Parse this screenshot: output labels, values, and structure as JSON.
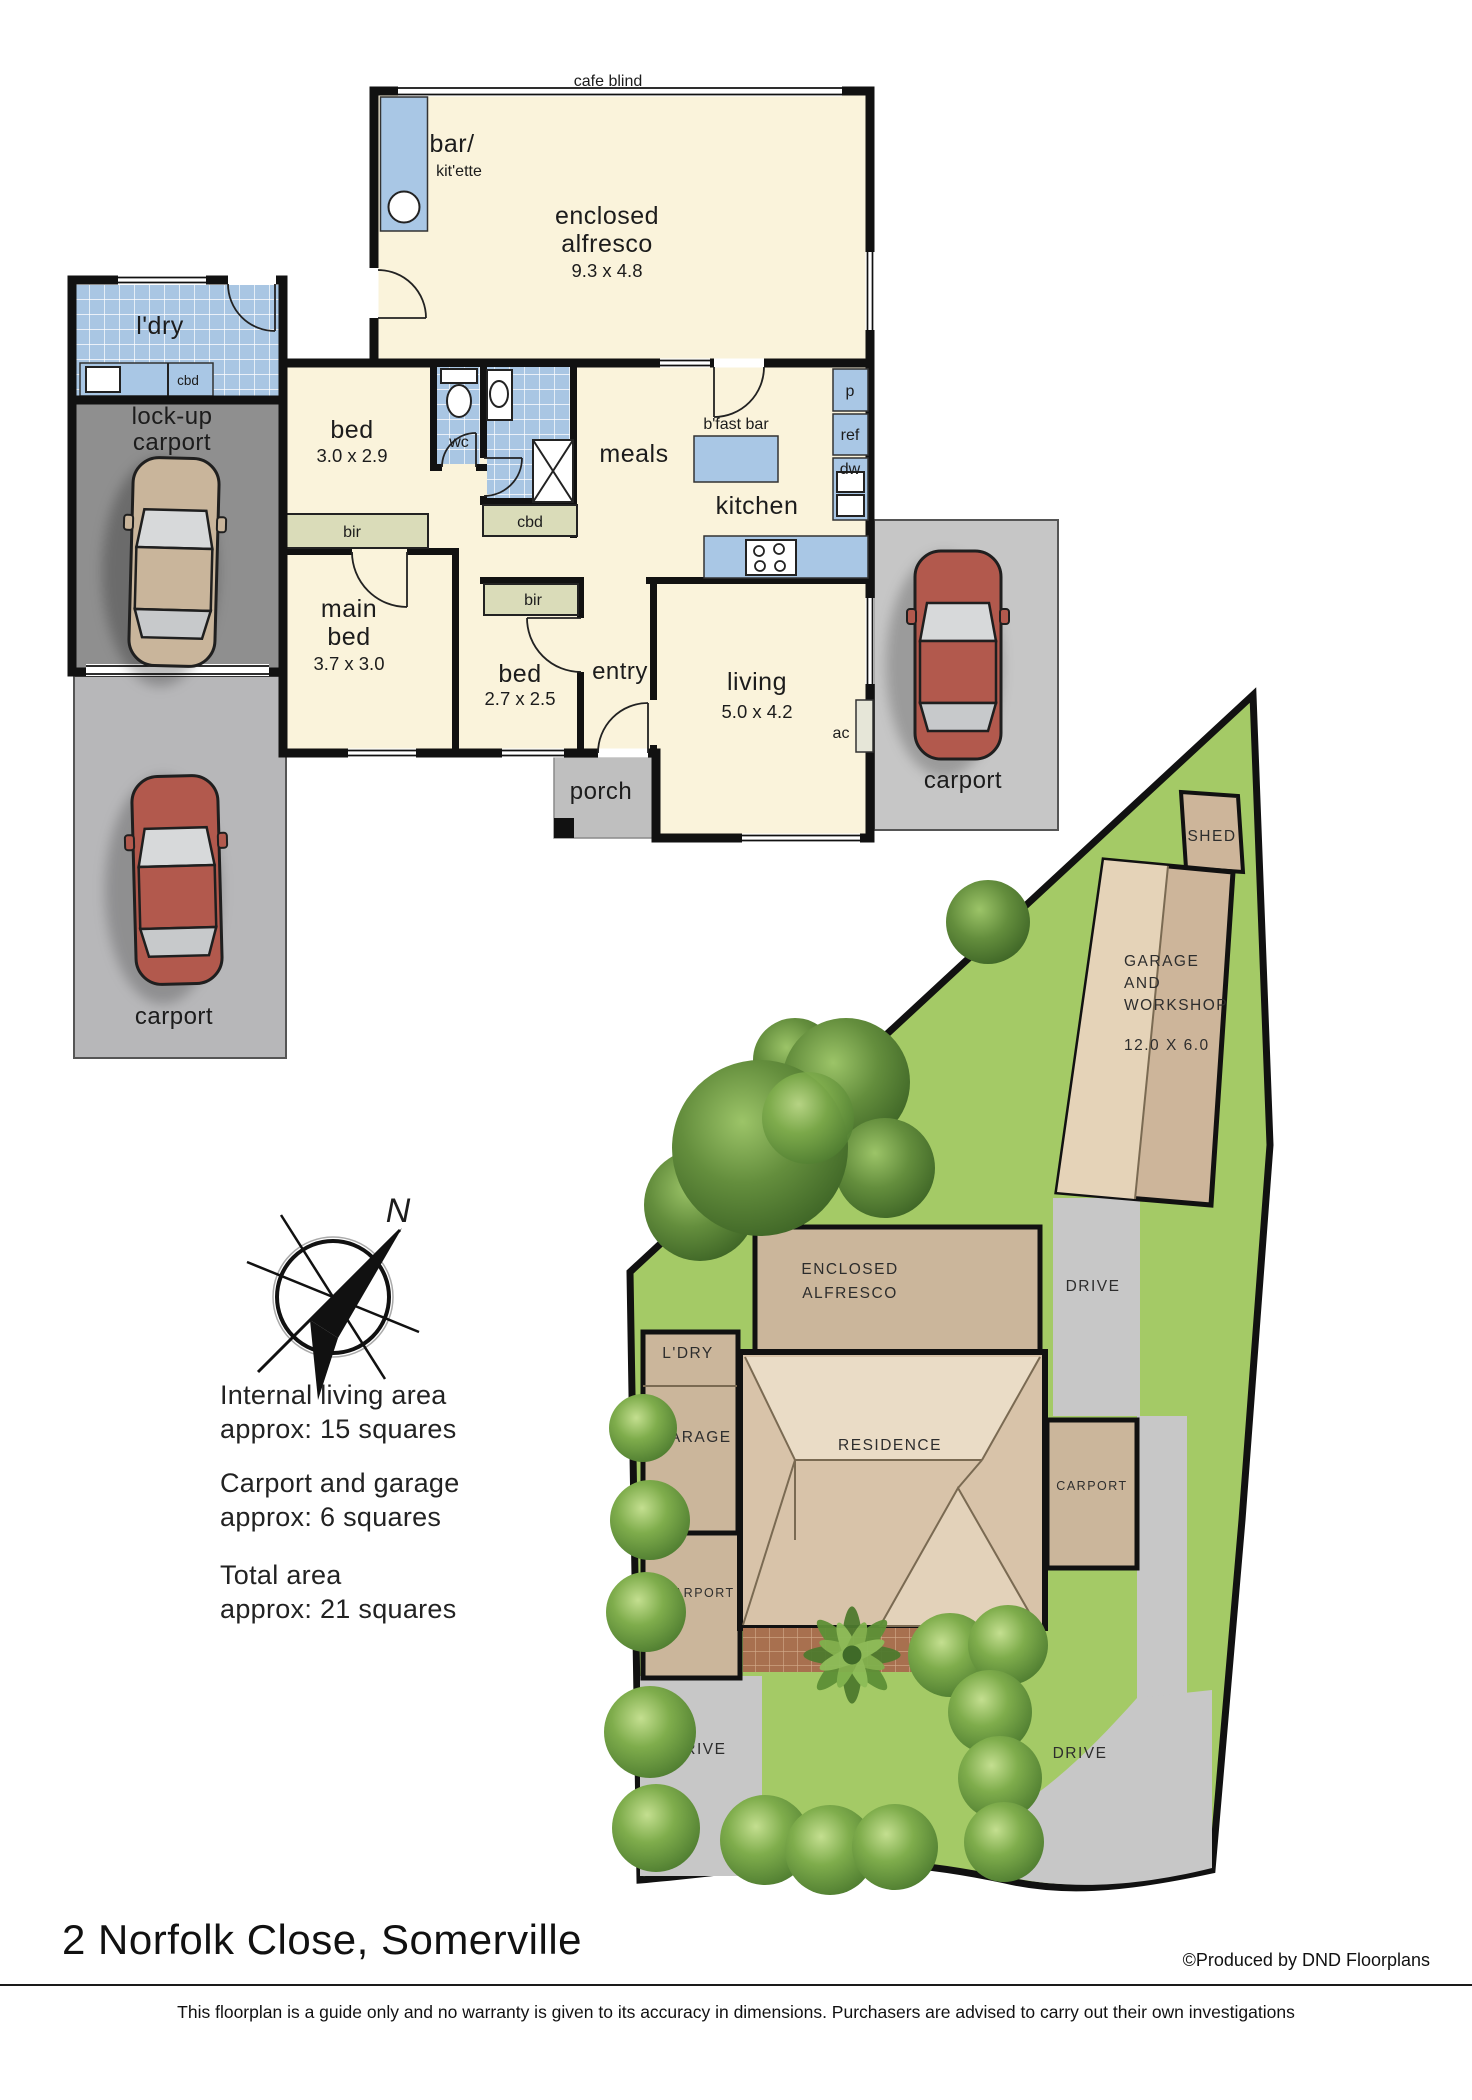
{
  "title": "2 Norfolk Close, Somerville",
  "credit": "©Produced by DND Floorplans",
  "disclaimer": "This floorplan is a guide only and no warranty is given to  its accuracy in dimensions.  Purchasers are advised to carry out their own investigations",
  "compass": {
    "north": "N"
  },
  "areas": {
    "internal_1": "Internal living area",
    "internal_2": "approx: 15 squares",
    "garage_1": "Carport and garage",
    "garage_2": "approx: 6 squares",
    "total_1": "Total area",
    "total_2": "approx: 21 squares"
  },
  "floorplan": {
    "cafe_blind": "cafe blind",
    "bar_1": "bar/",
    "bar_2": "kit'ette",
    "alfresco_1": "enclosed",
    "alfresco_2": "alfresco",
    "alfresco_dims": "9.3 x 4.8",
    "ldry": "l'dry",
    "cbd_ldry": "cbd",
    "lockup_1": "lock-up",
    "lockup_2": "carport",
    "bed2": "bed",
    "bed2_dims": "3.0 x 2.9",
    "wc": "wc",
    "cbd_hall": "cbd",
    "meals": "meals",
    "bfast_bar": "b'fast bar",
    "kitchen": "kitchen",
    "pantry": "p",
    "ref": "ref",
    "dw": "dw",
    "bir_main": "bir",
    "main_1": "main",
    "main_2": "bed",
    "main_dims": "3.7 x 3.0",
    "bir_bed3": "bir",
    "bed3": "bed",
    "bed3_dims": "2.7 x 2.5",
    "entry": "entry",
    "living": "living",
    "living_dims": "5.0 x 4.2",
    "ac": "ac",
    "porch": "porch",
    "carport_left": "carport",
    "carport_right": "carport"
  },
  "siteplan": {
    "shed": "SHED",
    "gw_1": "GARAGE",
    "gw_2": "AND",
    "gw_3": "WORKSHOP",
    "gw_dims": "12.0 X 6.0",
    "drive_upper": "DRIVE",
    "alfresco_1": "ENCLOSED",
    "alfresco_2": "ALFRESCO",
    "ldry": "L'DRY",
    "garage": "GARAGE",
    "residence": "RESIDENCE",
    "carport_right": "CARPORT",
    "carport_left": "CARPORT",
    "drive_left": "DRIVE",
    "drive_right": "DRIVE"
  },
  "colors": {
    "wall": "#111111",
    "floor": "#FAF3DB",
    "tile_blue": "#A9C6E3",
    "counter_blue": "#A9C7E5",
    "joinery_olive": "#DADCB9",
    "carport_dark": "#8F8F8F",
    "carport_light": "#B7B7B9",
    "porch_grey": "#BFBFBF",
    "lawn_green": "#A4CA66",
    "building_tan": "#CBB69B",
    "roof_light": "#EADCC6",
    "drive_grey": "#C7C7C7",
    "brick": "#A8704F",
    "car_red": "#B2594D",
    "car_beige": "#C9B59B"
  }
}
